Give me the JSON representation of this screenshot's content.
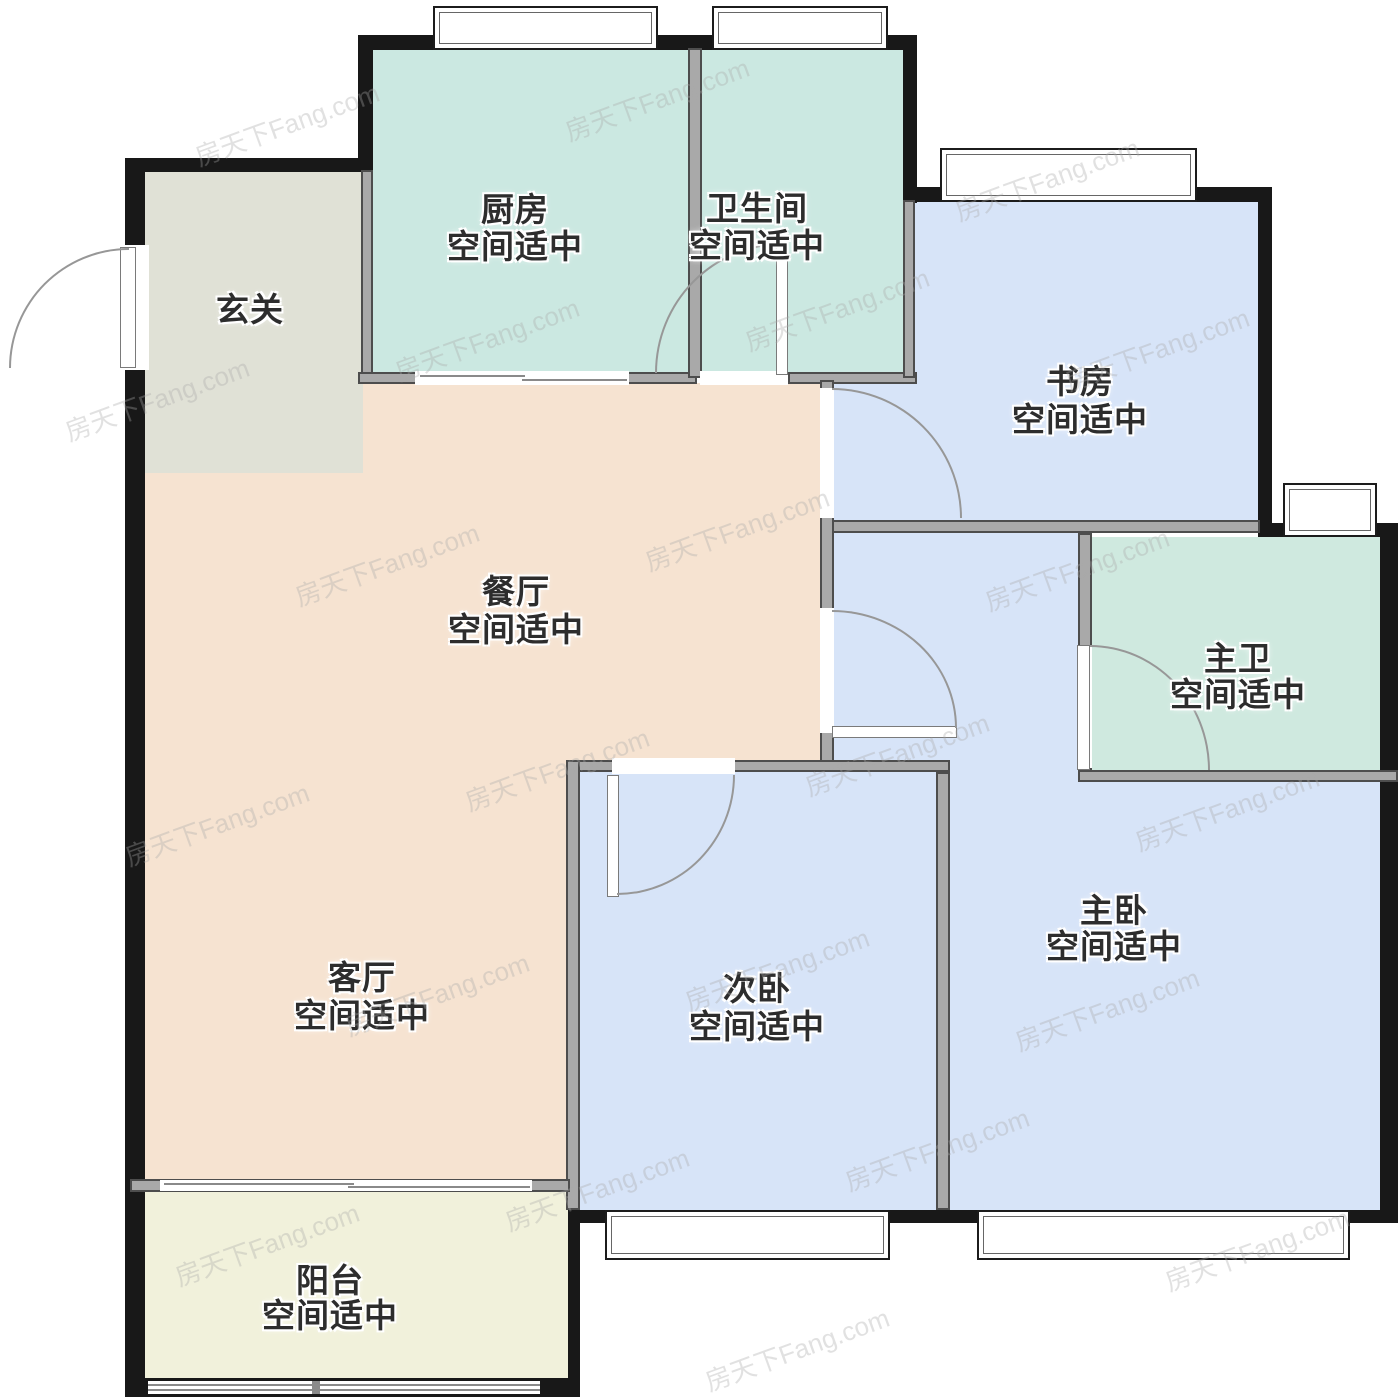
{
  "watermark": {
    "text": "房天下Fang.com"
  },
  "rooms": [
    {
      "id": "entry",
      "name": "玄关",
      "status": "",
      "color": "#e0e1d6"
    },
    {
      "id": "kitchen",
      "name": "厨房",
      "status": "空间适中",
      "color": "#cbe8e1"
    },
    {
      "id": "bathroom",
      "name": "卫生间",
      "status": "空间适中",
      "color": "#cbe8e1"
    },
    {
      "id": "study",
      "name": "书房",
      "status": "空间适中",
      "color": "#d7e4f8"
    },
    {
      "id": "dining",
      "name": "餐厅",
      "status": "空间适中",
      "color": "#f6e3d1"
    },
    {
      "id": "master-bath",
      "name": "主卫",
      "status": "空间适中",
      "color": "#cfe9df"
    },
    {
      "id": "living",
      "name": "客厅",
      "status": "空间适中",
      "color": "#f6e3d1"
    },
    {
      "id": "second-bedroom",
      "name": "次卧",
      "status": "空间适中",
      "color": "#d7e4f8"
    },
    {
      "id": "master-bedroom",
      "name": "主卧",
      "status": "空间适中",
      "color": "#d7e4f8"
    },
    {
      "id": "balcony",
      "name": "阳台",
      "status": "空间适中",
      "color": "#f1f1db"
    }
  ],
  "palette": {
    "exterior_wall": "#181818",
    "interior_wall": "#a9a9a9",
    "door_arc": "#979797",
    "window_frame": "#1c1c1c",
    "outside": "#ffffff"
  }
}
